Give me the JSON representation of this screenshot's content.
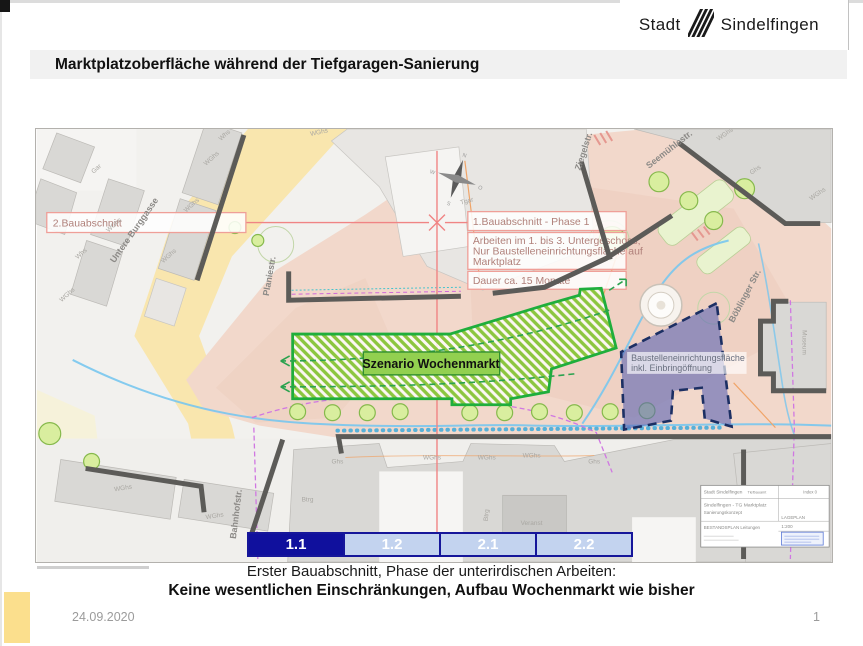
{
  "slide": {
    "logo": {
      "word1": "Stadt",
      "word2": "Sindelfingen"
    },
    "title": "Marktplatzoberfläche während der Tiefgaragen-Sanierung",
    "caption": {
      "line1": "Erster Bauabschnitt, Phase der unterirdischen Arbeiten:",
      "line2": "Keine wesentlichen Einschränkungen, Aufbau Wochenmarkt wie bisher"
    },
    "footer": {
      "date": "24.09.2020",
      "page_number": "1"
    }
  },
  "map": {
    "callouts": {
      "bauabschnitt_2": "2.Bauabschnitt",
      "bauabschnitt_1": "1.Bauabschnitt - Phase 1",
      "arbeiten_line1": "Arbeiten im 1. bis 3. Untergeschoss;",
      "arbeiten_line2": "Nur Baustelleneinrichtungsfläche auf",
      "arbeiten_line3": "Marktplatz",
      "dauer": "Dauer ca. 15 Monate"
    },
    "zones": {
      "szenario_label": "Szenario Wochenmarkt",
      "baustelle_line1": "Baustelleneinrichtungsfläche",
      "baustelle_line2": "inkl. Einbringöffnung"
    },
    "phases": {
      "p1_1": "1.1",
      "p1_2": "1.2",
      "p2_1": "2.1",
      "p2_2": "2.2",
      "active": "1.1"
    },
    "streets": {
      "untere_burggasse": "Untere Burggasse",
      "planiestr": "Planiestr.",
      "ziegelstr": "Ziegelstr.",
      "seemuehlestr": "Seemühlestr.",
      "boeblinger": "Böblinger Str.",
      "bahnhofstr": "Bahnhofstr."
    },
    "buildings": {
      "wghs": "WGhs",
      "whs": "Whs",
      "ghs": "Ghs",
      "gar": "Gar",
      "btrg": "Btrg",
      "veranst": "Veranst",
      "tgar": "Tgar",
      "museum": "Museum"
    },
    "compass": {
      "n": "N",
      "e": "O",
      "s": "S",
      "w": "W"
    },
    "titleblock": {
      "issuer": "Stadt Sindelfingen",
      "dept": "Tiefbauamt",
      "index": "Index 0",
      "project": "Sindelfingen - TG Marktplatz",
      "subtitle": "Sanierungskonzept",
      "plan": "BESTANDSPLAN Leitungen",
      "plan_type": "LAGEPLAN",
      "scale": "1:200"
    }
  },
  "colors": {
    "accent_green": "#1fae3c",
    "hatch_green": "#8cc63f",
    "label_green": "#92d050",
    "zone_blue": "#5a64b4",
    "zone_blue_border": "#1c2f63",
    "phase_active": "#10109d",
    "phase_inactive": "#c3d3ef",
    "phase_border": "#16169a",
    "callout_red": "#ef9f98",
    "street_yellow": "#f9e6ae",
    "market_pink": "#f2d8cb",
    "building_gray": "#d9d8d5",
    "highlight_yellow": "#fbdf8d"
  }
}
